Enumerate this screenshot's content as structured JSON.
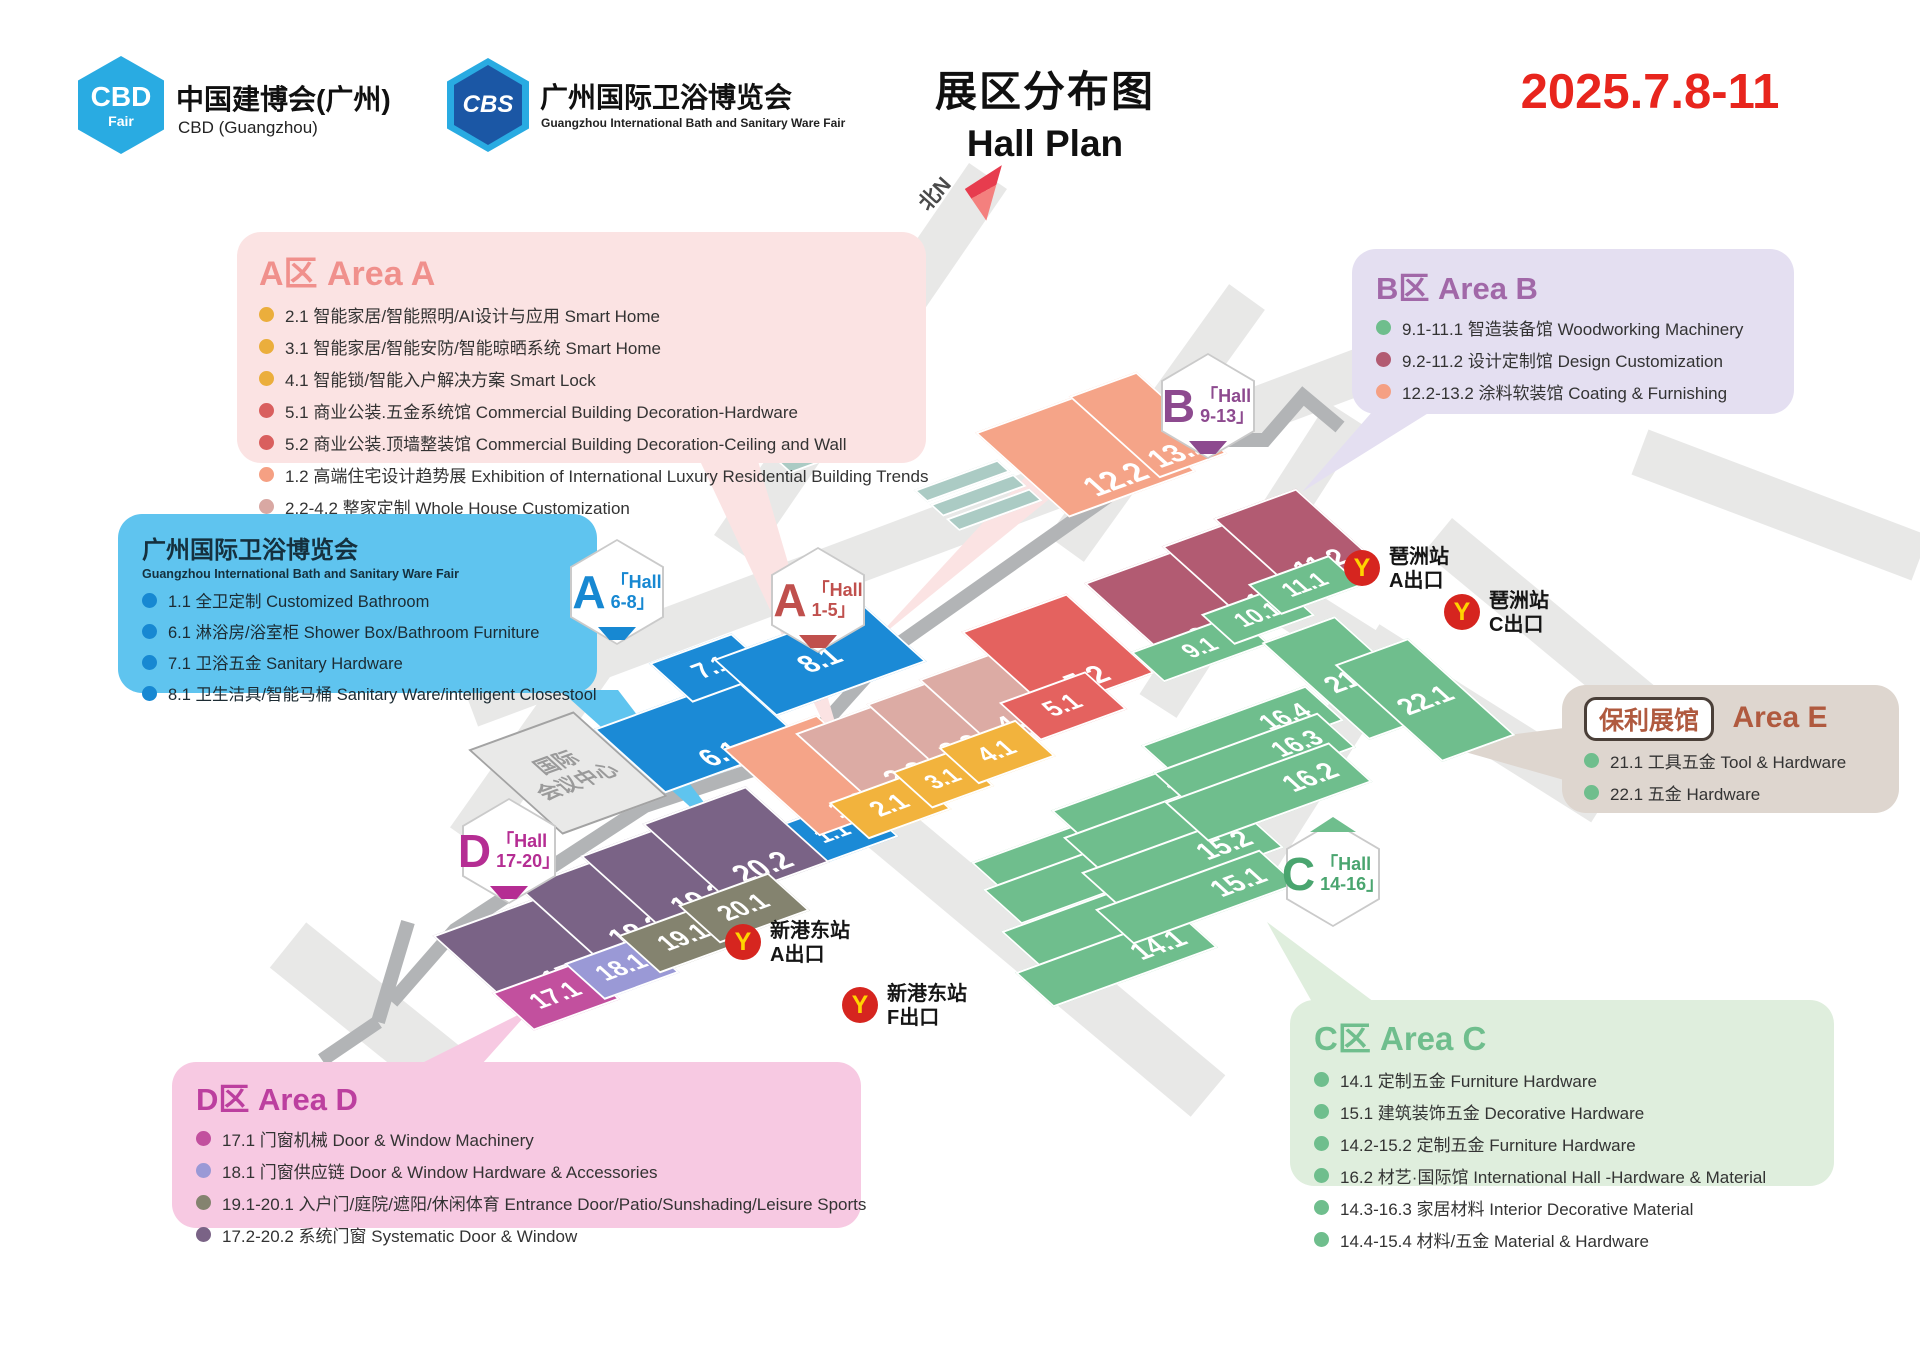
{
  "header": {
    "cbd_logo_line1": "CBD",
    "cbd_logo_line2": "Fair",
    "cbd_title": "中国建博会(广州)",
    "cbd_subtitle": "CBD (Guangzhou)",
    "cbs_logo": "CBS",
    "cbs_title": "广州国际卫浴博览会",
    "cbs_subtitle": "Guangzhou International Bath and Sanitary Ware Fair",
    "title_cn": "展区分布图",
    "title_en": "Hall Plan",
    "date": "2025.7.8-11",
    "date_color": "#E8251D"
  },
  "legends": {
    "areaA": {
      "title": "A区 Area A",
      "items": [
        {
          "dot": "#EBAE3C",
          "text": "2.1 智能家居/智能照明/AI设计与应用 Smart Home"
        },
        {
          "dot": "#EBAE3C",
          "text": "3.1 智能家居/智能安防/智能晾晒系统 Smart Home"
        },
        {
          "dot": "#EBAE3C",
          "text": "4.1 智能锁/智能入户解决方案 Smart Lock"
        },
        {
          "dot": "#D95F5E",
          "text": "5.1 商业公装.五金系统馆 Commercial Building Decoration-Hardware"
        },
        {
          "dot": "#D95F5E",
          "text": "5.2 商业公装.顶墙整装馆 Commercial Building Decoration-Ceiling and Wall"
        },
        {
          "dot": "#F5A083",
          "text": "1.2 高端住宅设计趋势展 Exhibition of International Luxury Residential Building Trends"
        },
        {
          "dot": "#D9A8A3",
          "text": "2.2-4.2 整家定制 Whole House Customization"
        }
      ]
    },
    "areaB": {
      "title": "B区 Area B",
      "items": [
        {
          "dot": "#6FBE8D",
          "text": "9.1-11.1 智造装备馆 Woodworking Machinery"
        },
        {
          "dot": "#B25B72",
          "text": "9.2-11.2 设计定制馆 Design Customization"
        },
        {
          "dot": "#F5A083",
          "text": "12.2-13.2 涂料软装馆 Coating & Furnishing"
        }
      ]
    },
    "bath": {
      "title": "广州国际卫浴博览会",
      "subtitle": "Guangzhou International Bath and Sanitary Ware Fair",
      "items": [
        {
          "dot": "#1788D2",
          "text": "1.1 全卫定制 Customized Bathroom"
        },
        {
          "dot": "#1788D2",
          "text": "6.1 淋浴房/浴室柜 Shower Box/Bathroom Furniture"
        },
        {
          "dot": "#1788D2",
          "text": "7.1 卫浴五金 Sanitary Hardware"
        },
        {
          "dot": "#1788D2",
          "text": "8.1 卫生洁具/智能马桶 Sanitary Ware/intelligent Closestool"
        }
      ]
    },
    "areaE": {
      "badge": "保利展馆",
      "title": "Area E",
      "items": [
        {
          "dot": "#6FBE8D",
          "text": "21.1 工具五金 Tool & Hardware"
        },
        {
          "dot": "#6FBE8D",
          "text": "22.1 五金 Hardware"
        }
      ]
    },
    "areaC": {
      "title": "C区 Area C",
      "items": [
        {
          "dot": "#6FBE8D",
          "text": "14.1 定制五金 Furniture Hardware"
        },
        {
          "dot": "#6FBE8D",
          "text": "15.1 建筑装饰五金 Decorative Hardware"
        },
        {
          "dot": "#6FBE8D",
          "text": "14.2-15.2 定制五金 Furniture Hardware"
        },
        {
          "dot": "#6FBE8D",
          "text": "16.2 材艺·国际馆 International Hall -Hardware & Material"
        },
        {
          "dot": "#6FBE8D",
          "text": "14.3-16.3 家居材料 Interior Decorative Material"
        },
        {
          "dot": "#6FBE8D",
          "text": "14.4-15.4 材料/五金 Material & Hardware"
        }
      ]
    },
    "areaD": {
      "title": "D区 Area D",
      "items": [
        {
          "dot": "#C2509E",
          "text": "17.1 门窗机械  Door & Window Machinery"
        },
        {
          "dot": "#9A99D6",
          "text": "18.1 门窗供应链  Door & Window Hardware & Accessories"
        },
        {
          "dot": "#84836F",
          "text": "19.1-20.1 入户门/庭院/遮阳/休闲体育 Entrance Door/Patio/Sunshading/Leisure Sports"
        },
        {
          "dot": "#7A6386",
          "text": "17.2-20.2 系统门窗 Systematic Door & Window"
        }
      ]
    }
  },
  "map": {
    "north_label": "北N",
    "convention_center": {
      "line1": "国际",
      "line2": "会议中心"
    },
    "halls": [
      {
        "label": "6.1",
        "color": "#1B8AD6",
        "x": 700,
        "y": 735,
        "w": 150,
        "h": 85,
        "fs": 27,
        "lp": "b"
      },
      {
        "label": "7.1",
        "color": "#1B8AD6",
        "x": 712,
        "y": 668,
        "w": 88,
        "h": 52,
        "fs": 24,
        "lp": "c"
      },
      {
        "label": "8.1",
        "color": "#1B8AD6",
        "x": 820,
        "y": 660,
        "w": 160,
        "h": 75,
        "fs": 27,
        "lp": "c"
      },
      {
        "label": "1.1",
        "color": "#1B8AD6",
        "x": 832,
        "y": 833,
        "w": 95,
        "h": 52,
        "fs": 22,
        "lp": "c"
      },
      {
        "label": "1.2",
        "color": "#F5A488",
        "x": 818,
        "y": 775,
        "w": 100,
        "h": 115,
        "fs": 28,
        "lp": "b"
      },
      {
        "label": "2.2",
        "color": "#DCABA4",
        "x": 882,
        "y": 752,
        "w": 100,
        "h": 95,
        "fs": 28,
        "lp": "b"
      },
      {
        "label": "3.2",
        "color": "#DCABA4",
        "x": 938,
        "y": 726,
        "w": 72,
        "h": 90,
        "fs": 26,
        "lp": "b"
      },
      {
        "label": "4.2",
        "color": "#DCABA4",
        "x": 994,
        "y": 700,
        "w": 80,
        "h": 90,
        "fs": 26,
        "lp": "b"
      },
      {
        "label": "5.2",
        "color": "#E4625F",
        "x": 1058,
        "y": 652,
        "w": 112,
        "h": 105,
        "fs": 28,
        "lp": "b"
      },
      {
        "label": "2.1",
        "color": "#F2B33D",
        "x": 890,
        "y": 806,
        "w": 88,
        "h": 48,
        "fs": 24,
        "lp": "c"
      },
      {
        "label": "3.1",
        "color": "#F2B33D",
        "x": 943,
        "y": 779,
        "w": 66,
        "h": 48,
        "fs": 22,
        "lp": "c"
      },
      {
        "label": "4.1",
        "color": "#F2B33D",
        "x": 997,
        "y": 752,
        "w": 82,
        "h": 48,
        "fs": 24,
        "lp": "c"
      },
      {
        "label": "5.1",
        "color": "#E4625F",
        "x": 1063,
        "y": 706,
        "w": 92,
        "h": 50,
        "fs": 24,
        "lp": "c"
      },
      {
        "label": "12.2",
        "color": "#F5A488",
        "x": 1085,
        "y": 452,
        "w": 135,
        "h": 112,
        "fs": 30,
        "lp": "b"
      },
      {
        "label": "13.2",
        "color": "#F5A488",
        "x": 1148,
        "y": 425,
        "w": 72,
        "h": 108,
        "fs": 28,
        "lp": "b"
      },
      {
        "label": "9.2",
        "color": "#B25B72",
        "x": 1182,
        "y": 605,
        "w": 112,
        "h": 108,
        "fs": 28,
        "lp": "b"
      },
      {
        "label": "10.2",
        "color": "#B25B72",
        "x": 1246,
        "y": 570,
        "w": 88,
        "h": 102,
        "fs": 26,
        "lp": "b"
      },
      {
        "label": "11.2",
        "color": "#B25B72",
        "x": 1295,
        "y": 540,
        "w": 88,
        "h": 96,
        "fs": 26,
        "lp": "b"
      },
      {
        "label": "9.1",
        "color": "#6FBE8D",
        "x": 1200,
        "y": 648,
        "w": 112,
        "h": 40,
        "fs": 22,
        "lp": "c"
      },
      {
        "label": "10.1",
        "color": "#6FBE8D",
        "x": 1258,
        "y": 615,
        "w": 86,
        "h": 40,
        "fs": 22,
        "lp": "c"
      },
      {
        "label": "11.1",
        "color": "#6FBE8D",
        "x": 1305,
        "y": 585,
        "w": 86,
        "h": 40,
        "fs": 22,
        "lp": "c"
      },
      {
        "label": "21.1",
        "color": "#6FBE8D",
        "x": 1352,
        "y": 678,
        "w": 78,
        "h": 128,
        "fs": 26,
        "lp": "c"
      },
      {
        "label": "22.1",
        "color": "#6FBE8D",
        "x": 1425,
        "y": 700,
        "w": 78,
        "h": 128,
        "fs": 26,
        "lp": "c"
      },
      {
        "label": "14.4",
        "color": "#6FBE8D",
        "x": 1072,
        "y": 850,
        "w": 175,
        "h": 46,
        "fs": 26,
        "lp": "r"
      },
      {
        "label": "14.3",
        "color": "#6FBE8D",
        "x": 1084,
        "y": 877,
        "w": 175,
        "h": 46,
        "fs": 26,
        "lp": "r"
      },
      {
        "label": "14.2",
        "color": "#6FBE8D",
        "x": 1102,
        "y": 919,
        "w": 175,
        "h": 46,
        "fs": 26,
        "lp": "r"
      },
      {
        "label": "14.1",
        "color": "#6FBE8D",
        "x": 1116,
        "y": 960,
        "w": 175,
        "h": 46,
        "fs": 26,
        "lp": "r"
      },
      {
        "label": "15.4",
        "color": "#6FBE8D",
        "x": 1152,
        "y": 798,
        "w": 175,
        "h": 46,
        "fs": 26,
        "lp": "r"
      },
      {
        "label": "15.3",
        "color": "#6FBE8D",
        "x": 1164,
        "y": 825,
        "w": 175,
        "h": 46,
        "fs": 26,
        "lp": "r"
      },
      {
        "label": "15.2",
        "color": "#6FBE8D",
        "x": 1182,
        "y": 860,
        "w": 175,
        "h": 46,
        "fs": 26,
        "lp": "r"
      },
      {
        "label": "15.1",
        "color": "#6FBE8D",
        "x": 1196,
        "y": 897,
        "w": 175,
        "h": 46,
        "fs": 26,
        "lp": "r"
      },
      {
        "label": "16.4",
        "color": "#6FBE8D",
        "x": 1242,
        "y": 733,
        "w": 175,
        "h": 46,
        "fs": 24,
        "lp": "r"
      },
      {
        "label": "16.3",
        "color": "#6FBE8D",
        "x": 1254,
        "y": 760,
        "w": 175,
        "h": 46,
        "fs": 24,
        "lp": "r"
      },
      {
        "label": "16.2",
        "color": "#6FBE8D",
        "x": 1268,
        "y": 792,
        "w": 175,
        "h": 52,
        "fs": 26,
        "lp": "r"
      },
      {
        "label": "17.2",
        "color": "#7A6386",
        "x": 545,
        "y": 948,
        "w": 150,
        "h": 100,
        "fs": 28,
        "lp": "b"
      },
      {
        "label": "18.2",
        "color": "#7A6386",
        "x": 612,
        "y": 907,
        "w": 110,
        "h": 100,
        "fs": 28,
        "lp": "b"
      },
      {
        "label": "19.2",
        "color": "#7A6386",
        "x": 674,
        "y": 875,
        "w": 110,
        "h": 100,
        "fs": 28,
        "lp": "b"
      },
      {
        "label": "20.2",
        "color": "#7A6386",
        "x": 736,
        "y": 843,
        "w": 110,
        "h": 100,
        "fs": 28,
        "lp": "b"
      },
      {
        "label": "17.1",
        "color": "#C2509E",
        "x": 556,
        "y": 996,
        "w": 92,
        "h": 50,
        "fs": 24,
        "lp": "c"
      },
      {
        "label": "18.1",
        "color": "#9A99D6",
        "x": 622,
        "y": 968,
        "w": 80,
        "h": 48,
        "fs": 24,
        "lp": "c"
      },
      {
        "label": "19.1",
        "color": "#84836F",
        "x": 684,
        "y": 938,
        "w": 96,
        "h": 50,
        "fs": 24,
        "lp": "c"
      },
      {
        "label": "20.1",
        "color": "#84836F",
        "x": 744,
        "y": 908,
        "w": 96,
        "h": 50,
        "fs": 24,
        "lp": "c"
      }
    ],
    "hexagons": [
      {
        "letter": "A",
        "line1": "「Hall",
        "line2": "6-8」",
        "color": "#1788D2",
        "x": 617,
        "y": 592,
        "pointer": "bottom"
      },
      {
        "letter": "A",
        "line1": "「Hall",
        "line2": "1-5」",
        "color": "#C0504D",
        "x": 818,
        "y": 600,
        "pointer": "bottom"
      },
      {
        "letter": "B",
        "line1": "「Hall",
        "line2": "9-13」",
        "color": "#8D4A8F",
        "x": 1208,
        "y": 406,
        "pointer": "bottom"
      },
      {
        "letter": "C",
        "line1": "「Hall",
        "line2": "14-16」",
        "color": "#4AA56F",
        "x": 1333,
        "y": 874,
        "pointer": "top",
        "pcolor": "#6FBE8D"
      },
      {
        "letter": "D",
        "line1": "「Hall",
        "line2": "17-20」",
        "color": "#B52D93",
        "x": 509,
        "y": 851,
        "pointer": "bottom"
      }
    ],
    "metro": [
      {
        "name": "琶洲站",
        "exit": "A出口",
        "x": 1362,
        "y": 568
      },
      {
        "name": "琶洲站",
        "exit": "C出口",
        "x": 1462,
        "y": 612
      },
      {
        "name": "新港东站",
        "exit": "A出口",
        "x": 743,
        "y": 942
      },
      {
        "name": "新港东站",
        "exit": "F出口",
        "x": 860,
        "y": 1005
      }
    ],
    "metro_glyph": "Y"
  }
}
